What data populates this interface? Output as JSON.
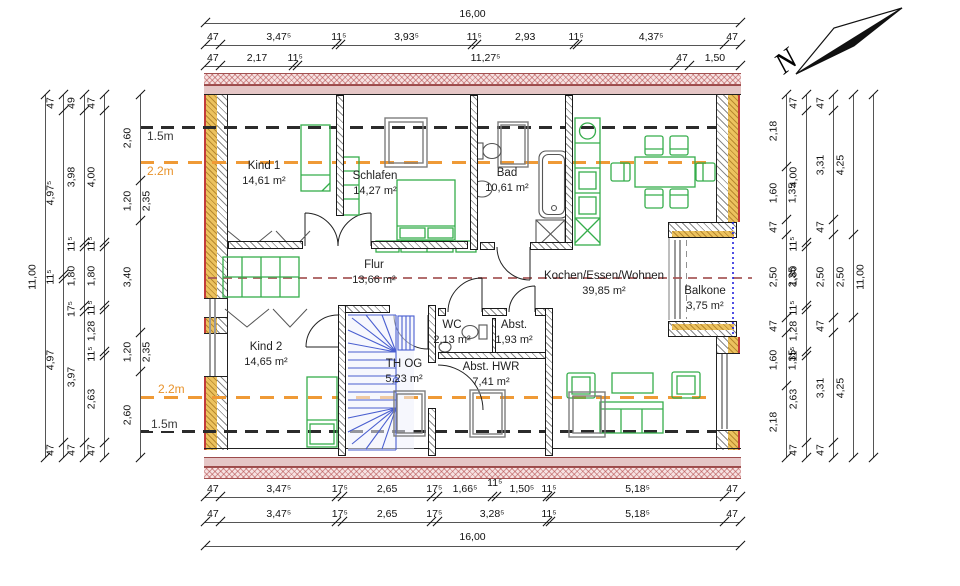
{
  "north": {
    "label": "N"
  },
  "height_markers": {
    "top_15": "1.5m",
    "top_22": "2.2m",
    "bottom_22": "2.2m",
    "bottom_15": "1.5m"
  },
  "rooms": [
    {
      "id": "kind1",
      "name": "Kind 1",
      "area": "14,61 m²"
    },
    {
      "id": "schlafen",
      "name": "Schlafen",
      "area": "14,27 m²"
    },
    {
      "id": "bad",
      "name": "Bad",
      "area": "10,61 m²"
    },
    {
      "id": "flur",
      "name": "Flur",
      "area": "13,66 m²"
    },
    {
      "id": "kochen",
      "name": "Kochen/Essen/Wohnen",
      "area": "39,85 m²"
    },
    {
      "id": "balkone",
      "name": "Balkone",
      "area": "3,75 m²"
    },
    {
      "id": "kind2",
      "name": "Kind 2",
      "area": "14,65 m²"
    },
    {
      "id": "thog",
      "name": "TH OG",
      "area": "5,23 m²"
    },
    {
      "id": "wc",
      "name": "WC",
      "area": "2,13 m²"
    },
    {
      "id": "abst",
      "name": "Abst.",
      "area": "1,93 m²"
    },
    {
      "id": "hwr",
      "name": "Abst. HWR",
      "area": "7,41 m²"
    }
  ],
  "dimensions": {
    "top": {
      "total": "16,00",
      "row2": [
        "47",
        "3,47⁵",
        "11⁵",
        "3,93⁵",
        "11⁵",
        "2,93",
        "11⁵",
        "4,37⁵",
        "47"
      ],
      "row3": [
        "47",
        "2,17",
        "11⁵",
        "11,27⁵",
        "47",
        "1,50"
      ]
    },
    "bottom": {
      "row1": [
        "47",
        "3,47⁵",
        "17⁵",
        "2,65",
        "17⁵",
        "1,66⁵",
        "^11⁵",
        "1,50⁵",
        "11⁵",
        "5,18⁵",
        "47"
      ],
      "row2": [
        "47",
        "3,47⁵",
        "17⁵",
        "2,65",
        "17⁵",
        "3,28⁵",
        "11⁵",
        "5,18⁵",
        "47"
      ],
      "total": "16,00"
    },
    "left": {
      "total": "11,00",
      "chains": [
        [
          "47",
          "4,97⁵",
          "11⁵",
          "4,97",
          "47"
        ],
        [
          "49",
          "3,98",
          "11⁵",
          "1,80",
          "17⁵",
          "3,97",
          "47"
        ],
        [
          "47",
          "4,00",
          "11⁵",
          "1,80",
          "11⁵",
          "1,28",
          "11⁵",
          "2,63",
          "47"
        ],
        [
          "2,60",
          "1,20|2,35",
          "3,40",
          "1,20|2,35",
          "2,60"
        ]
      ]
    },
    "right": {
      "total": "11,00",
      "chains": [
        [
          "2,18",
          "1,60|1,35",
          "47",
          "2,50|2,35",
          "47",
          "1,60|1,35",
          "2,18"
        ],
        [
          "47",
          "4,00",
          "11⁵",
          "1,80",
          "11⁵",
          "1,28",
          "11⁵",
          "2,63",
          "47"
        ],
        [
          "47",
          "3,31",
          "47",
          "2,50",
          "47",
          "3,31",
          "47"
        ],
        [
          "4,25",
          "2,50",
          "4,25"
        ]
      ]
    }
  },
  "colors": {
    "furniture_green": "#35ad4b",
    "fixture_gray": "#7d7d7d",
    "stair_blue": "#4a5fd0",
    "insulation_yellow": "#ecc25e",
    "exterior_red": "#c23b3b",
    "height_15": "#333333",
    "height_22": "#e8922a",
    "ridge_red": "#b25858",
    "balcony_rail_blue": "#2222dd"
  }
}
